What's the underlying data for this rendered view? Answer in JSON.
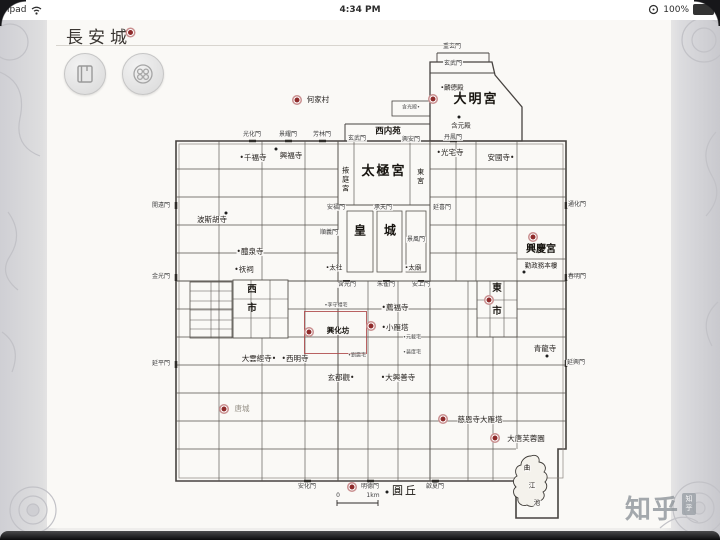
{
  "status_bar": {
    "carrier": "ipad",
    "time": "4:34 PM",
    "battery": "100%"
  },
  "header": {
    "title": "長安城"
  },
  "toolbar": {
    "buttons": [
      {
        "icon": "book-icon"
      },
      {
        "icon": "vessel-icon"
      }
    ]
  },
  "watermark": {
    "text": "知乎",
    "seal": "知乎"
  },
  "map": {
    "scale": {
      "start": "0",
      "end": "1km"
    },
    "accent_color": "#8f2b2b",
    "labels": [
      {
        "t": "重玄門",
        "x": 452,
        "y": 47,
        "c": "gate"
      },
      {
        "t": "玄武門",
        "x": 453,
        "y": 64,
        "c": "gate"
      },
      {
        "t": "•麟德殿",
        "x": 452,
        "y": 88,
        "c": "small"
      },
      {
        "t": "大明宮",
        "x": 476,
        "y": 100,
        "c": "palace"
      },
      {
        "t": "含元殿",
        "x": 461,
        "y": 126,
        "c": "small"
      },
      {
        "t": "含光殿•",
        "x": 411,
        "y": 108,
        "c": "tiny"
      },
      {
        "t": "西内苑",
        "x": 388,
        "y": 132,
        "c": "garden"
      },
      {
        "t": "玄武門",
        "x": 357,
        "y": 139,
        "c": "gate"
      },
      {
        "t": "興安門",
        "x": 411,
        "y": 140,
        "c": "gate"
      },
      {
        "t": "丹鳳門",
        "x": 453,
        "y": 138,
        "c": "gate"
      },
      {
        "t": "光化門",
        "x": 252,
        "y": 135,
        "c": "gate"
      },
      {
        "t": "景耀門",
        "x": 288,
        "y": 135,
        "c": "gate"
      },
      {
        "t": "芳林門",
        "x": 322,
        "y": 135,
        "c": "gate"
      },
      {
        "t": "何家村",
        "x": 318,
        "y": 100,
        "c": "temple"
      },
      {
        "t": "掖庭宮",
        "x": 345,
        "y": 180,
        "c": "wing"
      },
      {
        "t": "太極宮",
        "x": 384,
        "y": 172,
        "c": "palace"
      },
      {
        "t": "東宮",
        "x": 420,
        "y": 177,
        "c": "wing"
      },
      {
        "t": "安福門",
        "x": 336,
        "y": 208,
        "c": "gate"
      },
      {
        "t": "承天門",
        "x": 383,
        "y": 208,
        "c": "gate"
      },
      {
        "t": "延喜門",
        "x": 442,
        "y": 208,
        "c": "gate"
      },
      {
        "t": "順義門",
        "x": 329,
        "y": 233,
        "c": "gate"
      },
      {
        "t": "景風門",
        "x": 416,
        "y": 240,
        "c": "gate"
      },
      {
        "t": "皇",
        "x": 360,
        "y": 231,
        "c": "hall"
      },
      {
        "t": "城",
        "x": 390,
        "y": 231,
        "c": "hall"
      },
      {
        "t": "•太社",
        "x": 334,
        "y": 268,
        "c": "small"
      },
      {
        "t": "•太廟",
        "x": 413,
        "y": 268,
        "c": "small"
      },
      {
        "t": "含光門",
        "x": 347,
        "y": 285,
        "c": "gate"
      },
      {
        "t": "朱雀門",
        "x": 386,
        "y": 285,
        "c": "gate"
      },
      {
        "t": "安上門",
        "x": 421,
        "y": 285,
        "c": "gate"
      },
      {
        "t": "•千福寺",
        "x": 253,
        "y": 158,
        "c": "temple"
      },
      {
        "t": "興福寺",
        "x": 291,
        "y": 156,
        "c": "temple"
      },
      {
        "t": "波斯胡寺",
        "x": 212,
        "y": 220,
        "c": "temple"
      },
      {
        "t": "•醴泉寺",
        "x": 250,
        "y": 252,
        "c": "temple"
      },
      {
        "t": "•祆祠",
        "x": 244,
        "y": 270,
        "c": "temple"
      },
      {
        "t": "西",
        "x": 252,
        "y": 290,
        "c": "market"
      },
      {
        "t": "市",
        "x": 252,
        "y": 309,
        "c": "market"
      },
      {
        "t": "開遠門",
        "x": 161,
        "y": 206,
        "c": "gate"
      },
      {
        "t": "金光門",
        "x": 161,
        "y": 277,
        "c": "gate"
      },
      {
        "t": "延平門",
        "x": 161,
        "y": 364,
        "c": "gate"
      },
      {
        "t": "大雲經寺•",
        "x": 259,
        "y": 359,
        "c": "temple"
      },
      {
        "t": "•西明寺",
        "x": 295,
        "y": 359,
        "c": "temple"
      },
      {
        "t": "唐城",
        "x": 242,
        "y": 409,
        "c": "temple faint"
      },
      {
        "t": "•李守禮宅",
        "x": 336,
        "y": 306,
        "c": "tiny"
      },
      {
        "t": "興化坊",
        "x": 338,
        "y": 331,
        "c": "district"
      },
      {
        "t": "•劉震宅",
        "x": 357,
        "y": 356,
        "c": "tiny"
      },
      {
        "t": "•薦福寺",
        "x": 395,
        "y": 308,
        "c": "temple"
      },
      {
        "t": "•小雁塔",
        "x": 395,
        "y": 328,
        "c": "temple"
      },
      {
        "t": "•元載宅",
        "x": 412,
        "y": 338,
        "c": "tiny"
      },
      {
        "t": "•裴度宅",
        "x": 412,
        "y": 353,
        "c": "tiny"
      },
      {
        "t": "玄都觀•",
        "x": 341,
        "y": 378,
        "c": "temple"
      },
      {
        "t": "•大興善寺",
        "x": 398,
        "y": 378,
        "c": "temple"
      },
      {
        "t": "•光宅寺",
        "x": 450,
        "y": 153,
        "c": "temple"
      },
      {
        "t": "安國寺•",
        "x": 501,
        "y": 158,
        "c": "temple"
      },
      {
        "t": "東",
        "x": 497,
        "y": 289,
        "c": "market"
      },
      {
        "t": "市",
        "x": 497,
        "y": 312,
        "c": "market"
      },
      {
        "t": "興慶宮",
        "x": 541,
        "y": 250,
        "c": "xing"
      },
      {
        "t": "勤政務本樓",
        "x": 541,
        "y": 266,
        "c": "small"
      },
      {
        "t": "青龍寺",
        "x": 545,
        "y": 349,
        "c": "temple"
      },
      {
        "t": "通化門",
        "x": 577,
        "y": 205,
        "c": "gate"
      },
      {
        "t": "春明門",
        "x": 577,
        "y": 277,
        "c": "gate"
      },
      {
        "t": "延興門",
        "x": 576,
        "y": 363,
        "c": "gate"
      },
      {
        "t": "慈恩寺大雁塔",
        "x": 480,
        "y": 420,
        "c": "temple"
      },
      {
        "t": "大唐芙蓉園",
        "x": 526,
        "y": 439,
        "c": "temple"
      },
      {
        "t": "曲",
        "x": 527,
        "y": 468,
        "c": "small"
      },
      {
        "t": "江",
        "x": 532,
        "y": 486,
        "c": "small"
      },
      {
        "t": "池",
        "x": 537,
        "y": 503,
        "c": "small"
      },
      {
        "t": "圓丘",
        "x": 405,
        "y": 491,
        "c": "mound"
      },
      {
        "t": "安化門",
        "x": 307,
        "y": 487,
        "c": "gate"
      },
      {
        "t": "明德門",
        "x": 370,
        "y": 487,
        "c": "gate"
      },
      {
        "t": "啟夏門",
        "x": 435,
        "y": 487,
        "c": "gate"
      },
      {
        "t": "0",
        "x": 338,
        "y": 496,
        "c": "gate"
      },
      {
        "t": "1km",
        "x": 373,
        "y": 496,
        "c": "gate"
      }
    ],
    "markers": [
      {
        "type": "red",
        "x": 297,
        "y": 100,
        "site": "hejiacun"
      },
      {
        "type": "red",
        "x": 433,
        "y": 99,
        "site": "daminggong"
      },
      {
        "type": "red",
        "x": 309,
        "y": 332,
        "site": "xinghuafang"
      },
      {
        "type": "red",
        "x": 371,
        "y": 326,
        "site": "xiaoyanta"
      },
      {
        "type": "red",
        "x": 533,
        "y": 237,
        "site": "xingqinggong"
      },
      {
        "type": "red",
        "x": 489,
        "y": 300,
        "site": "dongshi"
      },
      {
        "type": "red",
        "x": 224,
        "y": 409,
        "site": "tangcheng"
      },
      {
        "type": "red",
        "x": 352,
        "y": 487,
        "site": "south-wall"
      },
      {
        "type": "red",
        "x": 443,
        "y": 419,
        "site": "dayanta"
      },
      {
        "type": "red",
        "x": 495,
        "y": 438,
        "site": "furongyuan"
      },
      {
        "type": "dot",
        "x": 276,
        "y": 149
      },
      {
        "type": "dot",
        "x": 226,
        "y": 213
      },
      {
        "type": "dot",
        "x": 459,
        "y": 117
      },
      {
        "type": "dot",
        "x": 547,
        "y": 356
      },
      {
        "type": "dot",
        "x": 524,
        "y": 272
      },
      {
        "type": "dot",
        "x": 387,
        "y": 492
      }
    ]
  }
}
